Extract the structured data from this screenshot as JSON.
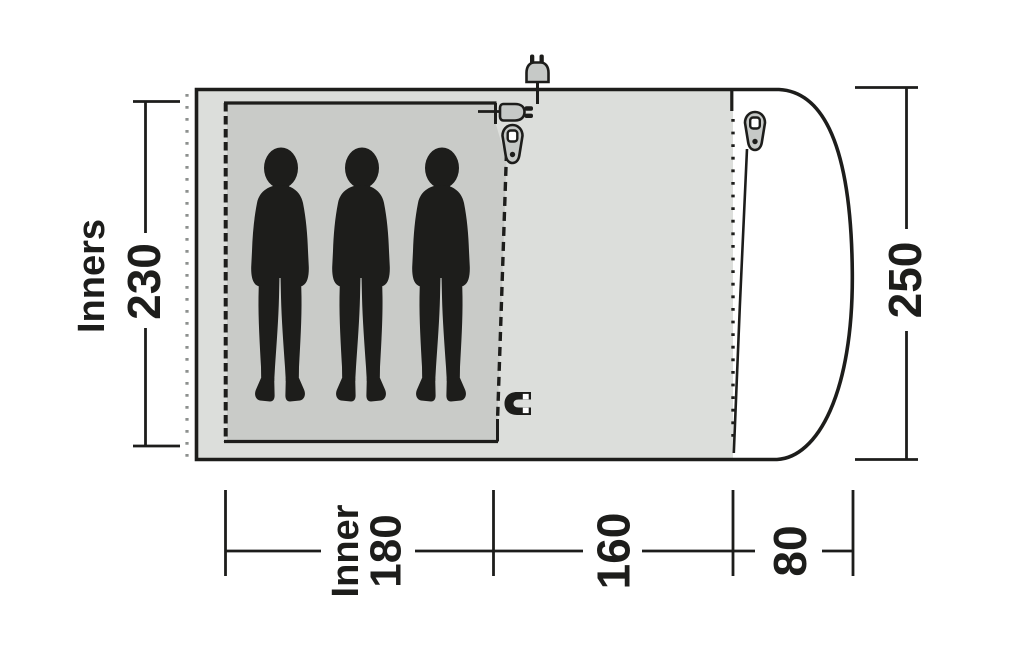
{
  "diagram": {
    "type": "tent-floorplan-top-view",
    "left_label": "Inners",
    "dimensions": {
      "inner_depth": "230",
      "total_depth": "250",
      "inner_width_label": "Inner",
      "inner_width": "180",
      "living_area_width": "160",
      "porch_depth": "80"
    },
    "occupants": 3,
    "icons": {
      "power_plug": "power-plug-icon",
      "cable_entry": "cable-entry-plug-icon",
      "inner_door_zipper": "zipper-pull-icon",
      "porch_door_zipper": "zipper-pull-icon",
      "magnet_closure": "magnet-icon"
    },
    "colors": {
      "tent_fill": "#dcdedb",
      "inner_fill": "#c9cbc8",
      "icon_fill": "#c6c9c7",
      "line": "#1d1d1b",
      "dotted_gray": "#8d908e",
      "background": "#ffffff"
    }
  }
}
